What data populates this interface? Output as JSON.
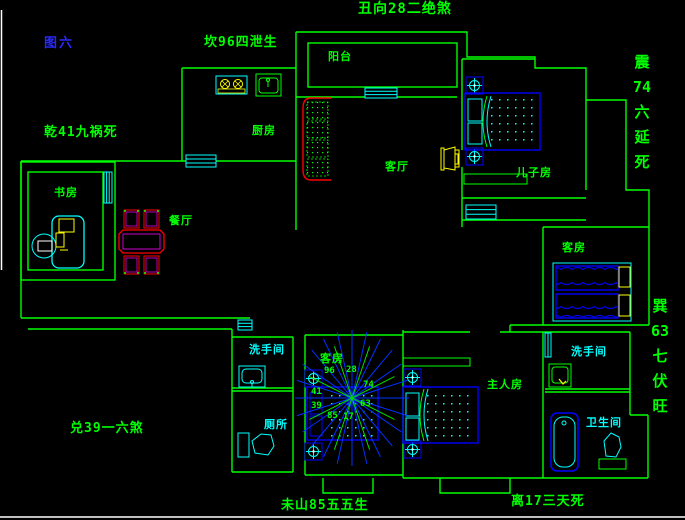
{
  "figure_label": "图六",
  "perimeter_annotations": {
    "top_left": "坎96四泄生",
    "top_center": "丑向28二绝煞",
    "left": "乾41九祸死",
    "right_upper": [
      "震",
      "74",
      "六",
      "延",
      "死"
    ],
    "right_lower": [
      "巽",
      "63",
      "七",
      "伏",
      "旺"
    ],
    "bottom_left": "兑39一六煞",
    "bottom_center": "未山85五五生",
    "bottom_right": "离17三天死"
  },
  "rooms": {
    "balcony": "阳台",
    "kitchen": "厨房",
    "living_room": "客厅",
    "sons_room": "儿子房",
    "study": "书房",
    "dining_room": "餐厅",
    "guest_room": "客房",
    "washroom_1": "洗手间",
    "toilet": "厕所",
    "stair_room": "客房",
    "master_room": "主人房",
    "washroom_2": "洗手间",
    "bathroom": "卫生间"
  },
  "compass_numbers": {
    "n96": "96",
    "n28": "28",
    "n74": "74",
    "n63": "63",
    "n41": "41",
    "n39": "39",
    "n85": "85",
    "n17": "17"
  },
  "colors": {
    "background": "#000000",
    "walls": "#00ff00",
    "fixtures": "#00ffff",
    "furniture_blue": "#0000ff",
    "sofa_red": "#ff0000",
    "accent_magenta": "#ff00ff",
    "equipment_yellow": "#ffff00",
    "figure_label_blue": "#2a2aff",
    "frame_white": "#ffffff"
  }
}
